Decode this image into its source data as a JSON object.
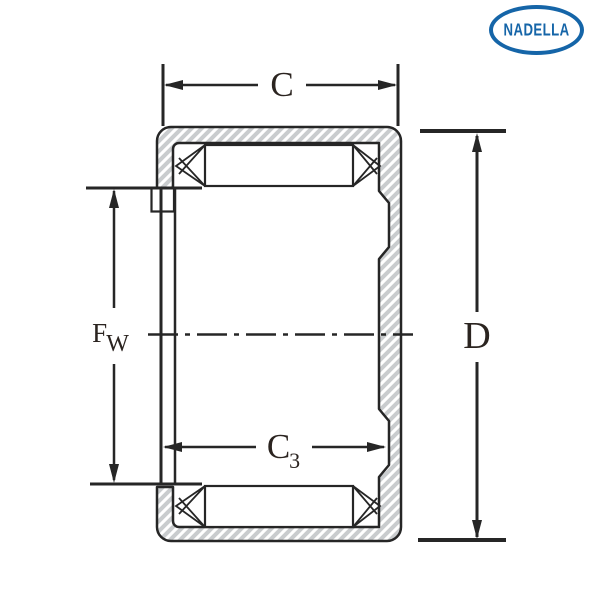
{
  "drawing": {
    "kind": "bearing-cross-section",
    "component": "drawn cup needle roller bearing, closed end"
  },
  "logo": {
    "text": "NADELLA"
  },
  "labels": {
    "c": {
      "main": "C"
    },
    "d": {
      "main": "D"
    },
    "fw": {
      "main": "F",
      "sub": "W"
    },
    "c3": {
      "main": "C",
      "sub": "3"
    }
  },
  "colors": {
    "line": "#262626",
    "hatch_stripe": "#c9ccce",
    "shell_fill": "#ffffff",
    "logo_blue": "#1565a8",
    "label_text": "#2b2420",
    "background": "#ffffff"
  }
}
